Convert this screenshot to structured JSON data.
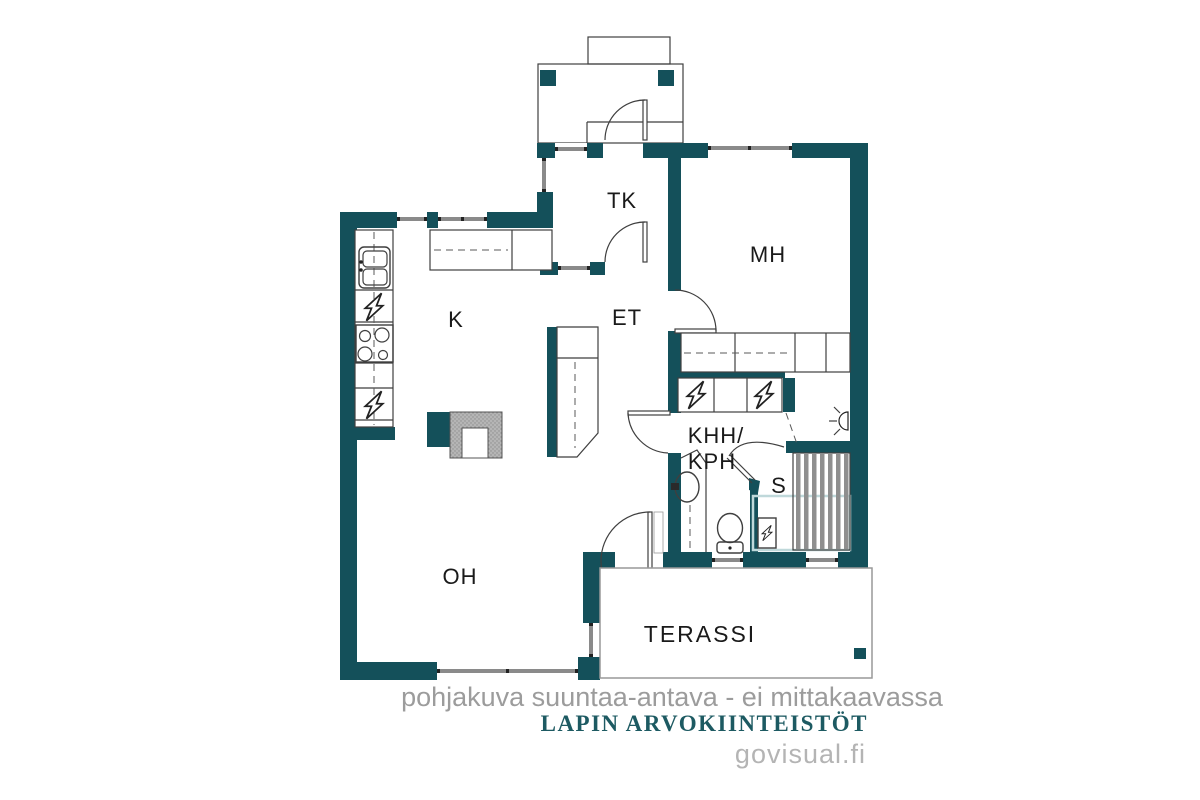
{
  "colors": {
    "bg": "#ffffff",
    "wall": "#14505a",
    "outline": "#3f3f3f",
    "window_band": "#8a8a8a",
    "fireplace_gray": "#b5b5b5",
    "sauna_floor": "#bfd8da",
    "bench": "#8f8f8f",
    "note_gray": "#9c9c9c",
    "brand_teal": "#1d5a62",
    "site_gray": "#b4b4b4",
    "label": "#1a1a1a"
  },
  "rooms": {
    "tk": "TK",
    "mh": "MH",
    "k": "K",
    "et": "ET",
    "khh_line1": "KHH/",
    "khh_line2": "KPH",
    "s": "S",
    "oh": "OH",
    "terassi": "TERASSI"
  },
  "footer": {
    "note": "pohjakuva suuntaa-antava - ei mittakaavassa",
    "brand": "LAPIN ARVOKIINTEISTÖT",
    "site": "govisual.fi"
  },
  "icons": {
    "appliance": "lightning-bolt-icon",
    "sauna_heater": "lightning-bolt-icon",
    "wall_lamp": "lamp-icon",
    "stove": "four-burner-icon",
    "kitchen_sink": "double-basin-icon",
    "bathroom_sink": "oval-basin-icon",
    "toilet": "wc-icon"
  }
}
